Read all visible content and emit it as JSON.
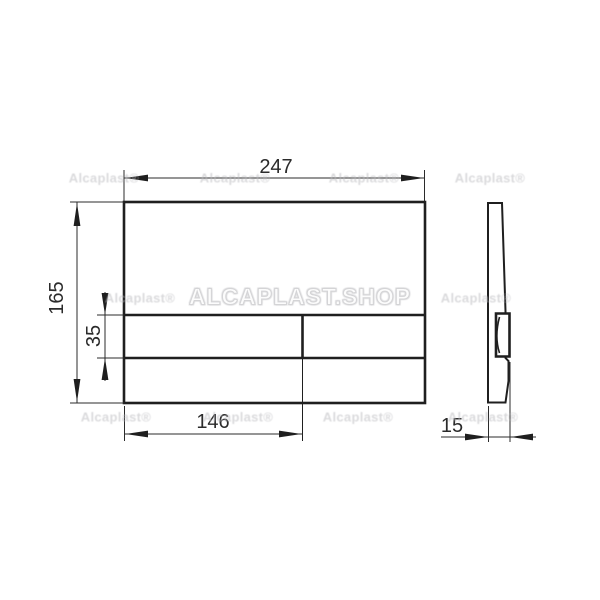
{
  "drawing": {
    "dimension_labels": {
      "overall_width": "247",
      "overall_height": "165",
      "button_row_height": "35",
      "big_button_width": "146",
      "plate_depth": "15"
    },
    "watermarks": {
      "main": "ALCAPLAST.SHOP",
      "small": "Alcaplast®"
    },
    "colors": {
      "background": "#ffffff",
      "line": "#1f1f1f",
      "dimension_text": "#2b2b2b",
      "watermark_small": "#bcbcc0",
      "watermark_main_outline": "#d4d4d6"
    }
  }
}
